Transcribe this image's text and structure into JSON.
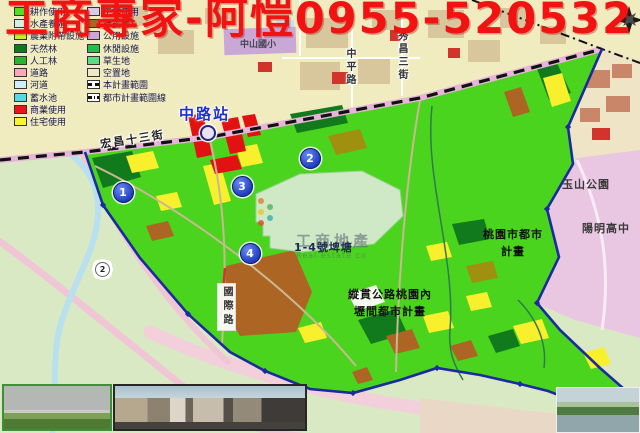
{
  "title": "工商專家-阿愷0955-520532",
  "colors": {
    "title_red": "#f11212",
    "plan_area_green": "#4bd41d",
    "boundary_blue": "#1b2a9e",
    "urban_plan_pink": "#e9c6e2",
    "urban_band_yellow": "#f1ecc0",
    "pond_pale": "#cfe9c6"
  },
  "legend": {
    "columns": [
      {
        "items": [
          {
            "label": "耕作使用",
            "color": "#52e01e"
          },
          {
            "label": "水產養殖",
            "color": "#d2f2e4"
          },
          {
            "label": "農業附帶設施",
            "color": "#c3ef2d"
          },
          {
            "label": "天然林",
            "color": "#0e7a1a"
          },
          {
            "label": "人工林",
            "color": "#2eb32e"
          },
          {
            "label": "道路",
            "color": "#f5a9bd"
          },
          {
            "label": "河道",
            "color": "#cfeef8"
          },
          {
            "label": "蓄水池",
            "color": "#59d6e8"
          },
          {
            "label": "商業使用",
            "color": "#ea1515"
          },
          {
            "label": "住宅使用",
            "color": "#fbf32b"
          }
        ]
      },
      {
        "items": [
          {
            "label": "工業使用",
            "color": "#d9c9ea"
          },
          {
            "label": "裸露地",
            "color": "#ad6524"
          },
          {
            "label": "公用設施",
            "color": "#c9a8d6"
          },
          {
            "label": "休閒設施",
            "color": "#1fc04a"
          },
          {
            "label": "草生地",
            "color": "#5cdc82"
          },
          {
            "label": "空置地",
            "color": "#efeabf"
          },
          {
            "label": "本計畫範圍",
            "symbol": "dash"
          },
          {
            "label": "都市計畫範圍線",
            "symbol": "dashdot"
          }
        ]
      }
    ]
  },
  "map": {
    "station": {
      "label": "中路站"
    },
    "route_shield": "2",
    "labels": [
      {
        "text": "宏昌十三街",
        "x": 100,
        "y": 131,
        "rotate": -9,
        "style": "street",
        "name": "street-label-hongchang-13"
      },
      {
        "text": "中山國小",
        "x": 240,
        "y": 37,
        "style": "small",
        "name": "label-zhongshan-elementary"
      },
      {
        "text": "中平路",
        "x": 342,
        "y": 48,
        "style": "street-v",
        "name": "street-label-zhongping-rd"
      },
      {
        "text": "秀昌三街",
        "x": 394,
        "y": 30,
        "style": "street-v",
        "name": "street-label-xiuchang-3rd"
      },
      {
        "text": "國際路",
        "x": 217,
        "y": 283,
        "style": "street-v-boxed",
        "name": "street-label-guoji-rd"
      },
      {
        "text": "玉山公園",
        "x": 562,
        "y": 176,
        "style": "area",
        "name": "label-yushan-park"
      },
      {
        "text": "陽明高中",
        "x": 582,
        "y": 220,
        "style": "area",
        "name": "label-yangming-highschool"
      },
      {
        "text": "桃園市都市\n計畫",
        "x": 477,
        "y": 227,
        "width": 72,
        "style": "plan",
        "name": "label-taoyuan-urban-plan"
      },
      {
        "text": "縱貫公路桃園內\n壢間都市計畫",
        "x": 338,
        "y": 287,
        "width": 104,
        "style": "plan",
        "name": "label-zongguan-highway-plan"
      },
      {
        "text": "1-4號埤塘",
        "x": 294,
        "y": 239,
        "style": "pond",
        "name": "label-pond-1-4"
      }
    ],
    "markers": [
      {
        "n": "1",
        "x": 122,
        "y": 191
      },
      {
        "n": "2",
        "x": 309,
        "y": 157
      },
      {
        "n": "3",
        "x": 241,
        "y": 185
      },
      {
        "n": "4",
        "x": 249,
        "y": 252
      }
    ]
  },
  "watermark": {
    "line1": "工商地產",
    "line2": "Real estate co",
    "dot_colors": [
      "#e08030",
      "#55b055",
      "#e8c820",
      "#35b0a8",
      "#d85030"
    ]
  },
  "photos": [
    {
      "name": "field-photo"
    },
    {
      "name": "street-scene-photo"
    },
    {
      "name": "river-photo"
    }
  ]
}
